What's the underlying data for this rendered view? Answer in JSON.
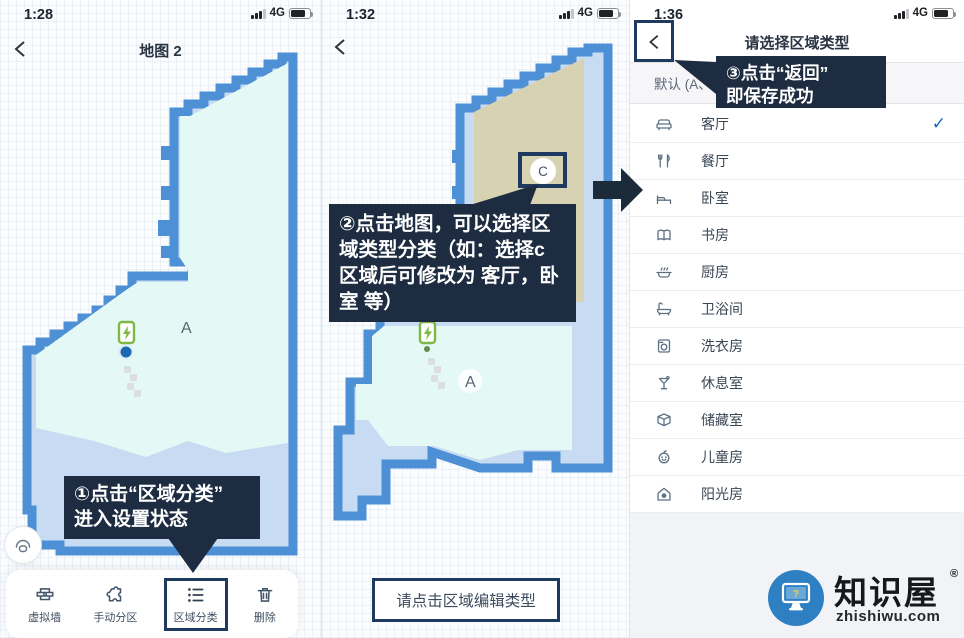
{
  "colors": {
    "accent_navy": "#1e3a5f",
    "callout_bg": "#1d2c40",
    "map_wall_blue": "#4e90d6",
    "map_floor_cyan": "#e4f8f6",
    "map_patch_blue": "#c7dcf2",
    "region_c_tan": "#d7d3b2",
    "dock_green": "#7db843",
    "robot_blue": "#1b67b0",
    "check_blue": "#1668b3",
    "watermark_blue": "#2f80c3"
  },
  "screen1": {
    "status": {
      "time": "1:28",
      "network": "4G"
    },
    "nav": {
      "title": "地图 2"
    },
    "map": {
      "region_a_label": "A"
    },
    "callout": {
      "line1": "①点击“区域分类”",
      "line2": "进入设置状态"
    },
    "toolbar": {
      "items": [
        {
          "icon": "virtual-wall",
          "label": "虚拟墙"
        },
        {
          "icon": "puzzle-partition",
          "label": "手动分区"
        },
        {
          "icon": "area-category-list",
          "label": "区域分类"
        },
        {
          "icon": "trash",
          "label": "删除"
        }
      ]
    }
  },
  "screen2": {
    "status": {
      "time": "1:32",
      "network": "4G"
    },
    "map": {
      "region_a_label": "A",
      "region_c_label": "C"
    },
    "callout": {
      "lines": [
        "②点击地图，可以选择区",
        "域类型分类（如：选择c",
        "区域后可修改为 客厅，卧",
        "室 等）"
      ]
    },
    "hint_box": {
      "label": "请点击区域编辑类型"
    }
  },
  "screen3": {
    "status": {
      "time": "1:36",
      "network": "4G"
    },
    "nav": {
      "title": "请选择区域类型"
    },
    "callout": {
      "line1": "③点击“返回”",
      "line2": "即保存成功"
    },
    "default_row": {
      "label": "默认 (A、B"
    },
    "rooms": [
      {
        "icon": "sofa",
        "label": "客厅",
        "check": "✓"
      },
      {
        "icon": "cutlery",
        "label": "餐厅"
      },
      {
        "icon": "bed",
        "label": "卧室"
      },
      {
        "icon": "book",
        "label": "书房"
      },
      {
        "icon": "pot",
        "label": "厨房"
      },
      {
        "icon": "bathtub",
        "label": "卫浴间"
      },
      {
        "icon": "washing-machine",
        "label": "洗衣房"
      },
      {
        "icon": "cocktail",
        "label": "休息室"
      },
      {
        "icon": "storage-box",
        "label": "储藏室"
      },
      {
        "icon": "baby",
        "label": "儿童房"
      },
      {
        "icon": "sun-house",
        "label": "阳光房"
      }
    ]
  },
  "watermark": {
    "brand": "知识屋",
    "reg": "®",
    "site": "zhishiwu.com",
    "question_mark": "?"
  }
}
